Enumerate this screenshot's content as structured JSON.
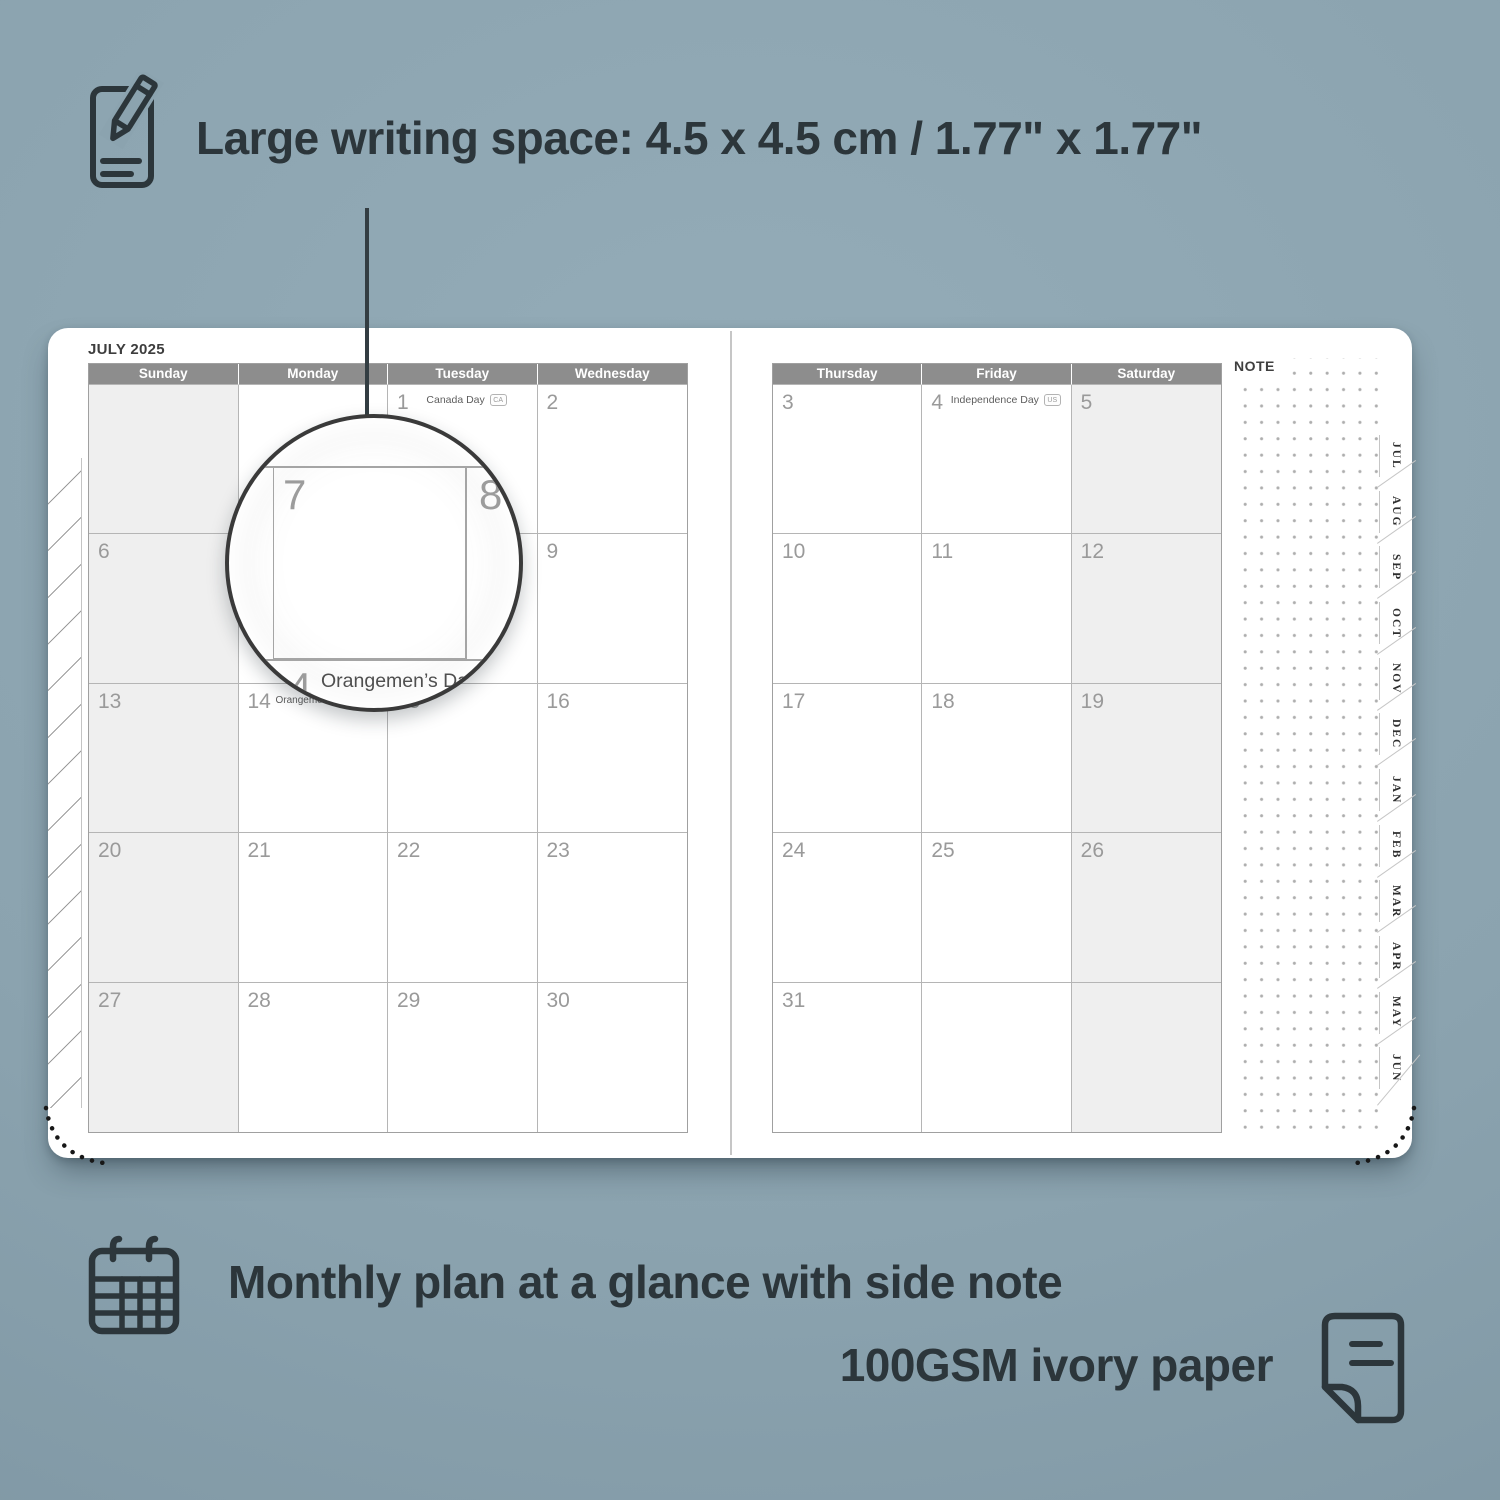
{
  "colors": {
    "background": "#8ba3af",
    "ink": "#2c363b",
    "header_bg": "#8d8d8d",
    "header_text": "#ffffff",
    "weekend_bg": "#efefef",
    "grid_line": "#b5b5b5",
    "date_number": "#9a9a9a",
    "paper": "#ffffff"
  },
  "top_annotation": {
    "text": "Large writing space: 4.5 x 4.5 cm / 1.77\" x 1.77\""
  },
  "planner": {
    "month_title": "JULY 2025",
    "note_label": "NOTE",
    "left_day_headers": [
      "Sunday",
      "Monday",
      "Tuesday",
      "Wednesday"
    ],
    "right_day_headers": [
      "Thursday",
      "Friday",
      "Saturday"
    ],
    "tabs": [
      "JUL",
      "AUG",
      "SEP",
      "OCT",
      "NOV",
      "DEC",
      "JAN",
      "FEB",
      "MAR",
      "APR",
      "MAY",
      "JUN"
    ],
    "left_cells": [
      [
        "",
        "",
        {
          "n": "1",
          "h": "Canada Day",
          "b": "CA",
          "hr": 30
        },
        "2"
      ],
      [
        "6",
        "7",
        "8",
        "9"
      ],
      [
        "13",
        {
          "n": "14",
          "h": "Orangemen’s Day (n.i.)",
          "b": "UK",
          "inline": true
        },
        "15",
        "16"
      ],
      [
        "20",
        "21",
        "22",
        "23"
      ],
      [
        "27",
        "28",
        "29",
        "30"
      ]
    ],
    "right_cells": [
      [
        "3",
        {
          "n": "4",
          "h": "Independence Day",
          "b": "US",
          "hr": 10
        },
        "5"
      ],
      [
        "10",
        "11",
        "12"
      ],
      [
        "17",
        "18",
        "19"
      ],
      [
        "24",
        "25",
        "26"
      ],
      [
        "31",
        "",
        ""
      ]
    ]
  },
  "magnifier": {
    "left_day": "7",
    "right_day": "8",
    "clipped_day": "14",
    "holiday": "Orangemen’s Day (n.i.)",
    "holiday_badge": "UK"
  },
  "bottom_annotations": {
    "line1": "Monthly plan at a glance with side note",
    "line2": "100GSM ivory paper"
  }
}
